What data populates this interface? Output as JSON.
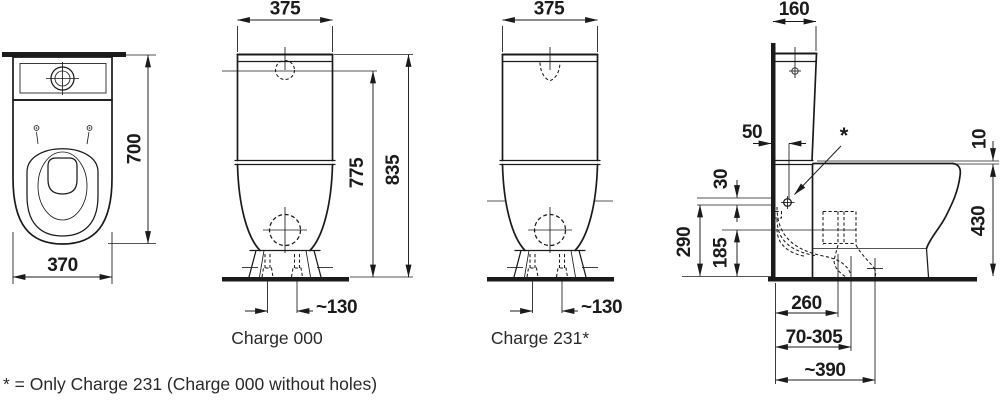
{
  "drawing": {
    "colors": {
      "line": "#1b1b1b",
      "background": "#ffffff"
    },
    "top_view": {
      "width": "370",
      "depth": "700"
    },
    "front_view_charge000": {
      "width": "375",
      "button_height": "775",
      "total_height": "835",
      "screw_spacing": "~130",
      "caption": "Charge 000"
    },
    "front_view_charge231": {
      "width": "375",
      "screw_spacing": "~130",
      "caption": "Charge 231*"
    },
    "side_view": {
      "cistern_depth": "160",
      "supply_offset": "50",
      "asterisk": "*",
      "rim_drop": "10",
      "hole_gap": "30",
      "supply_height": "290",
      "outlet_height": "185",
      "rim_height": "430",
      "outlet_back_distance": "260",
      "outlet_range": "70-305",
      "outlet_center_distance": "~390"
    },
    "footnote": "* = Only Charge 231 (Charge 000 without holes)"
  }
}
